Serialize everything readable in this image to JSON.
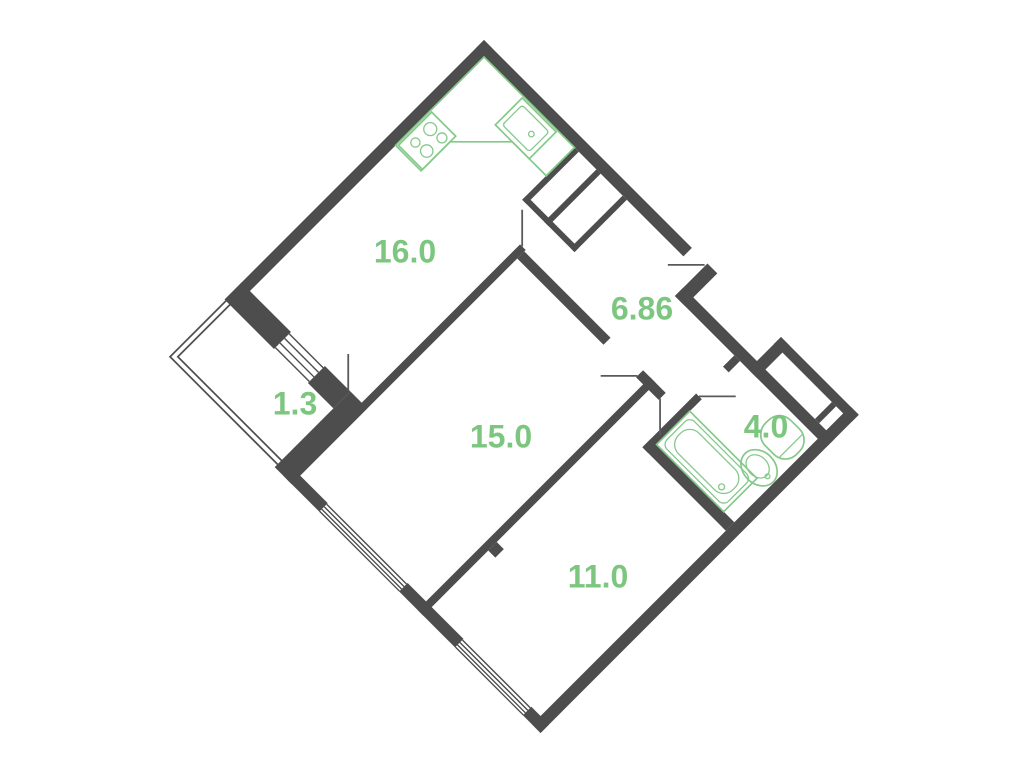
{
  "title": "2-room apartment floor plan",
  "orientation_deg": 45,
  "area_units": "m2",
  "colors": {
    "background": "#ffffff",
    "wall": "#4d4d4d",
    "fixture_green": "#85c98a",
    "label_green": "#7cc67f"
  },
  "rooms": [
    {
      "id": "kitchen",
      "area": "16.0"
    },
    {
      "id": "hallway",
      "area": "6.86"
    },
    {
      "id": "balcony",
      "area": "1.3"
    },
    {
      "id": "living-room",
      "area": "15.0"
    },
    {
      "id": "bathroom",
      "area": "4.0"
    },
    {
      "id": "bedroom",
      "area": "11.0"
    }
  ],
  "fixtures": [
    "kitchen-counter",
    "kitchen-stove",
    "kitchen-sink",
    "bathtub",
    "washbasin",
    "toilet"
  ],
  "features": [
    "entry-door",
    "kitchen-door",
    "living-room-door",
    "bedroom-door",
    "bathroom-door",
    "balcony-door",
    "living-room-window",
    "bedroom-window",
    "kitchen-balcony-window",
    "balcony-glazing",
    "ventilation-shaft",
    "entry-duct"
  ]
}
